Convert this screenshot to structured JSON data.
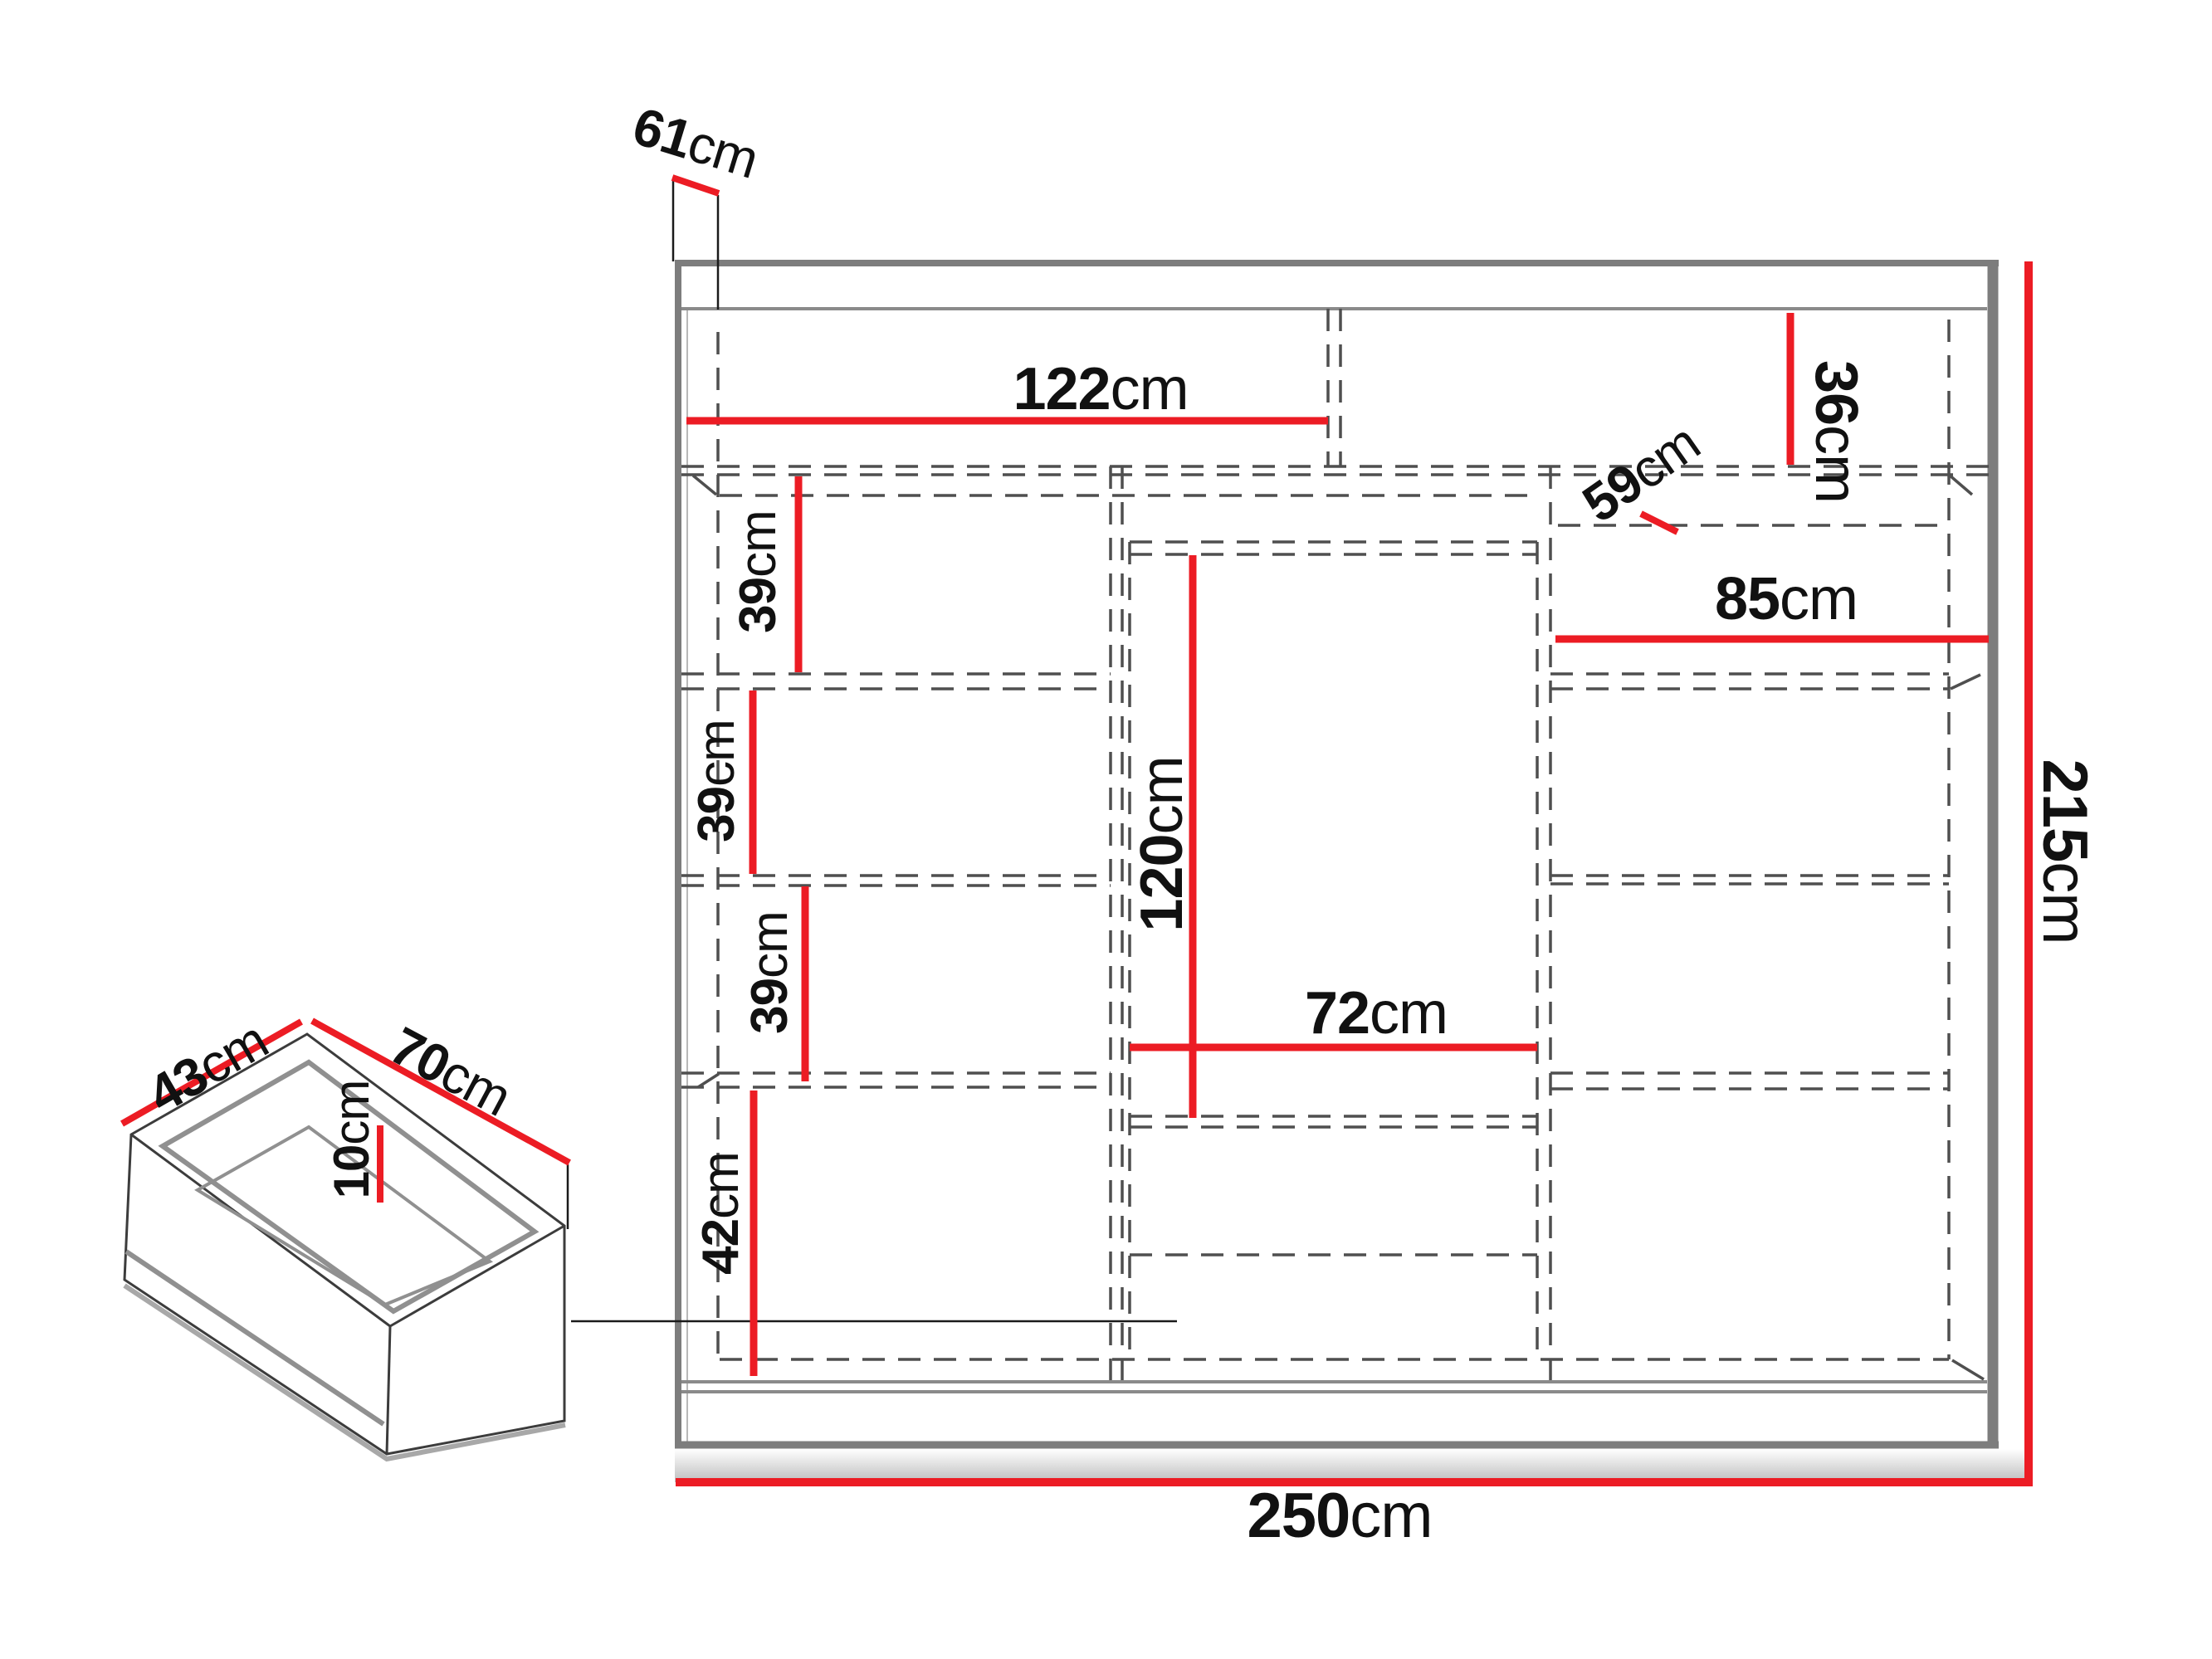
{
  "page": {
    "title": "Sliding wardrobe dimension diagram",
    "units": "cm"
  },
  "colors": {
    "dimension_red": "#ec1c24",
    "frame_gray": "#7d7d7d",
    "dashed_gray": "#4f4f4f",
    "text_black": "#111111"
  },
  "labels": {
    "l61": {
      "num": "61",
      "unit": "cm"
    },
    "l122": {
      "num": "122",
      "unit": "cm"
    },
    "l36": {
      "num": "36",
      "unit": "cm"
    },
    "l59": {
      "num": "59",
      "unit": "cm"
    },
    "l85": {
      "num": "85",
      "unit": "cm"
    },
    "l39a": {
      "num": "39",
      "unit": "cm"
    },
    "l39b": {
      "num": "39",
      "unit": "cm"
    },
    "l39c": {
      "num": "39",
      "unit": "cm"
    },
    "l42": {
      "num": "42",
      "unit": "cm"
    },
    "l120": {
      "num": "120",
      "unit": "cm"
    },
    "l72": {
      "num": "72",
      "unit": "cm"
    },
    "l215": {
      "num": "215",
      "unit": "cm"
    },
    "l250": {
      "num": "250",
      "unit": "cm"
    },
    "l43": {
      "num": "43",
      "unit": "cm"
    },
    "l70": {
      "num": "70",
      "unit": "cm"
    },
    "l10": {
      "num": "10",
      "unit": "cm"
    }
  }
}
